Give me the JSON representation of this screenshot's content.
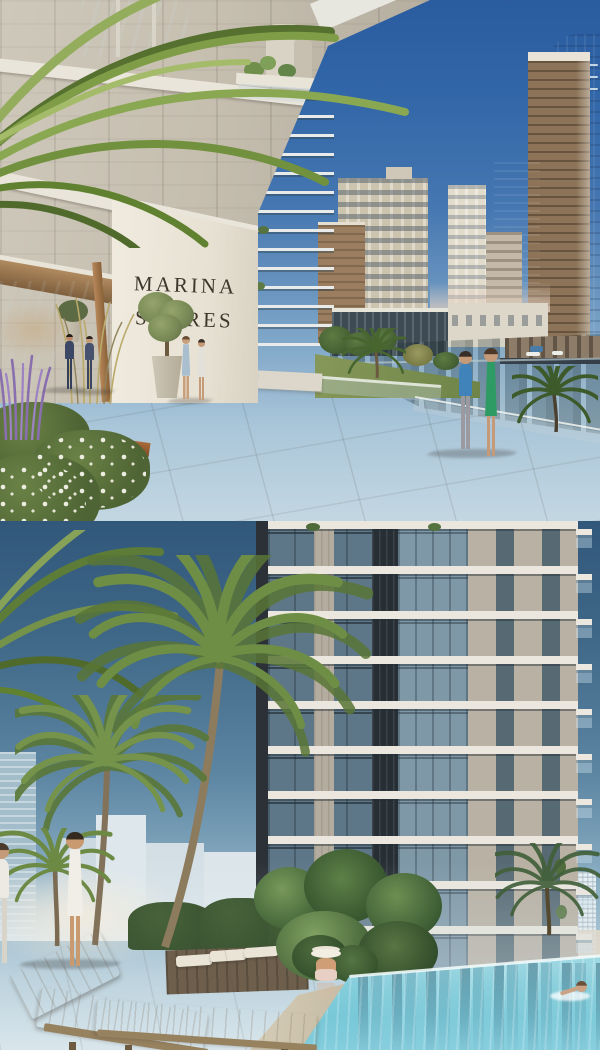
{
  "sign": {
    "line1": "MARINA",
    "line2": "SHORES"
  },
  "palette": {
    "sky_top": "#2a5c9f",
    "sky_horizon": "#c3d7e2",
    "sky2_top": "#31587b",
    "sky2_horizon": "#d9e6ec",
    "slab_white": "#e9e5da",
    "pillar_white": "#f0ebdf",
    "sign_text": "#3f362c",
    "marina_water": "#46616c",
    "pool_water": "#6cc2d3",
    "paving": "#c2bbad",
    "deck": "#bcb5a7",
    "hedge_green": "#3c5432",
    "tower_concrete": "#b9b1a3",
    "tower_glass": "#5e7788",
    "cushion": "#c9bda7"
  }
}
